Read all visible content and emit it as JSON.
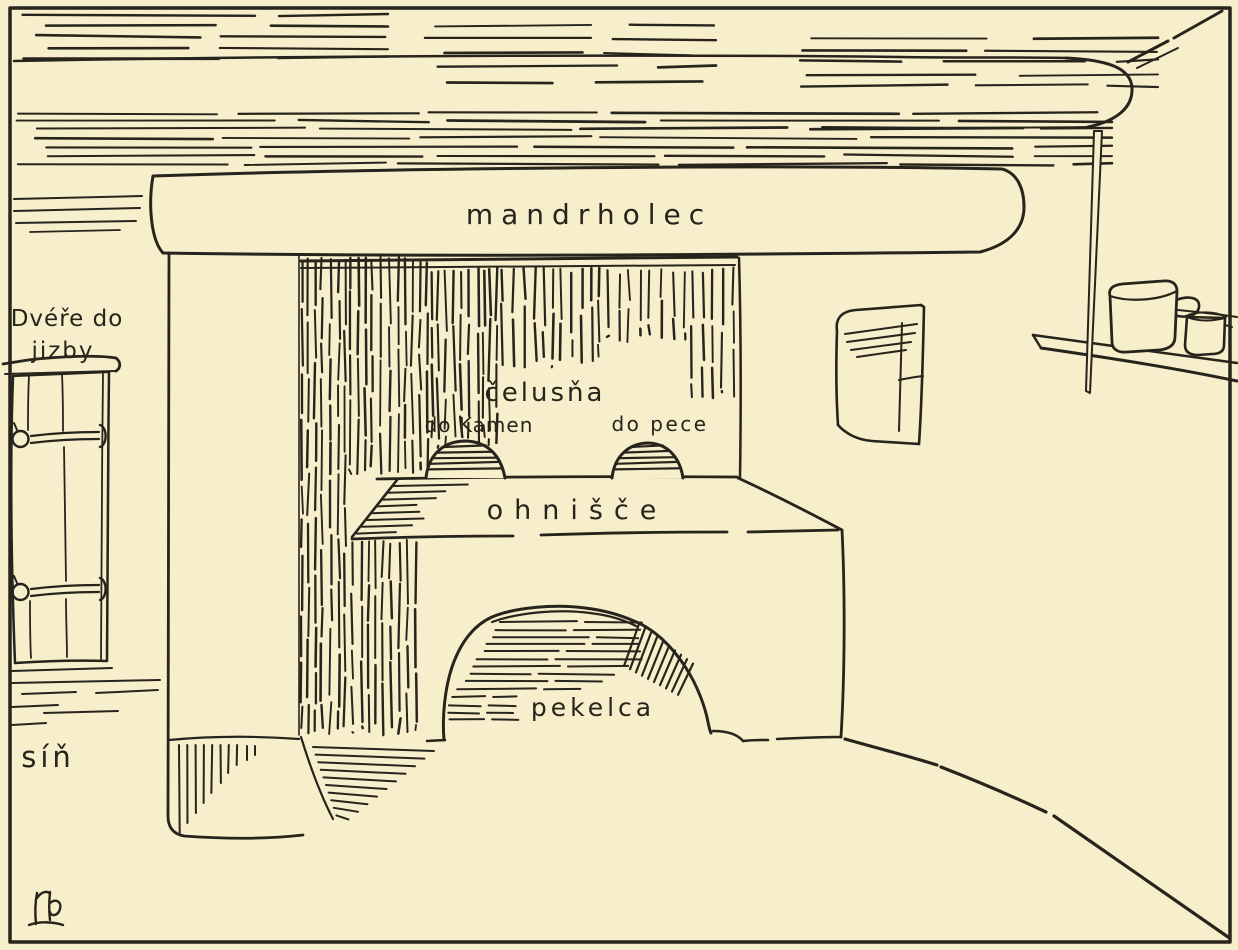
{
  "drawing": {
    "colors": {
      "paper": "#f7eecb",
      "ink": "#27241c"
    },
    "labels": {
      "mantel_beam": "mandrholec",
      "hood_mouth": "čelusňa",
      "stove_opening": "do Kamen",
      "oven_opening": "do pece",
      "hearth_top": "ohnišče",
      "under_hearth_niche": "pekelca",
      "door_caption_line1": "Dvéře do",
      "door_caption_line2": "jizby",
      "hall": "síň",
      "signature": "rb"
    }
  }
}
